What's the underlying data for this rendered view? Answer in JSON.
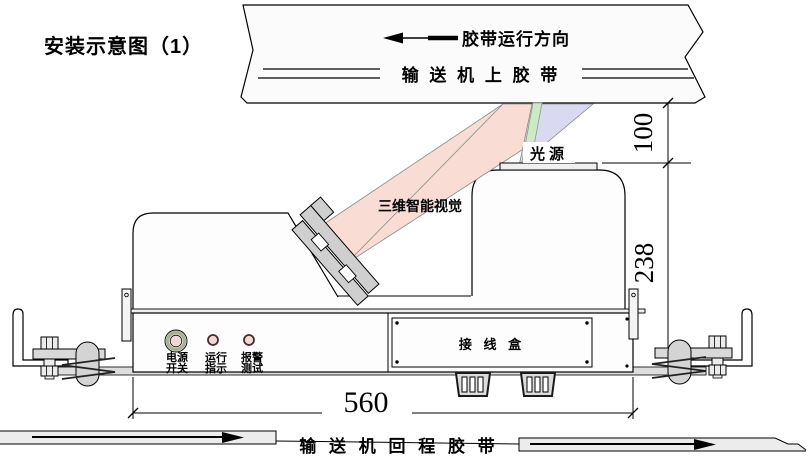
{
  "title": "安装示意图（1）",
  "upper_belt": {
    "direction_label": "胶带运行方向",
    "name_label": "输 送 机 上 胶 带"
  },
  "lower_belt": {
    "name_label": "输 送 机 回 程 胶 带"
  },
  "device": {
    "vision_label": "三维智能视觉",
    "light_source_label": "光源",
    "junction_box_label": "接 线 盒",
    "control_panel": {
      "indicators": [
        {
          "line1": "电源",
          "line2": "开关"
        },
        {
          "line1": "运行",
          "line2": "指示"
        },
        {
          "line1": "报警",
          "line2": "测试"
        }
      ]
    }
  },
  "dimensions": {
    "belt_clearance": "100",
    "device_height": "238",
    "device_width": "560"
  },
  "colors": {
    "camera_beam": "#f9ddd5",
    "light_cone": "#d9d9f2",
    "laser_line": "#cde9c5",
    "metal": "#cfcfcf",
    "metal_light": "#dedede",
    "indicator_pink": "#f2d8d3",
    "power_ring": "#a7b392",
    "belt_gray": "#ececec"
  }
}
